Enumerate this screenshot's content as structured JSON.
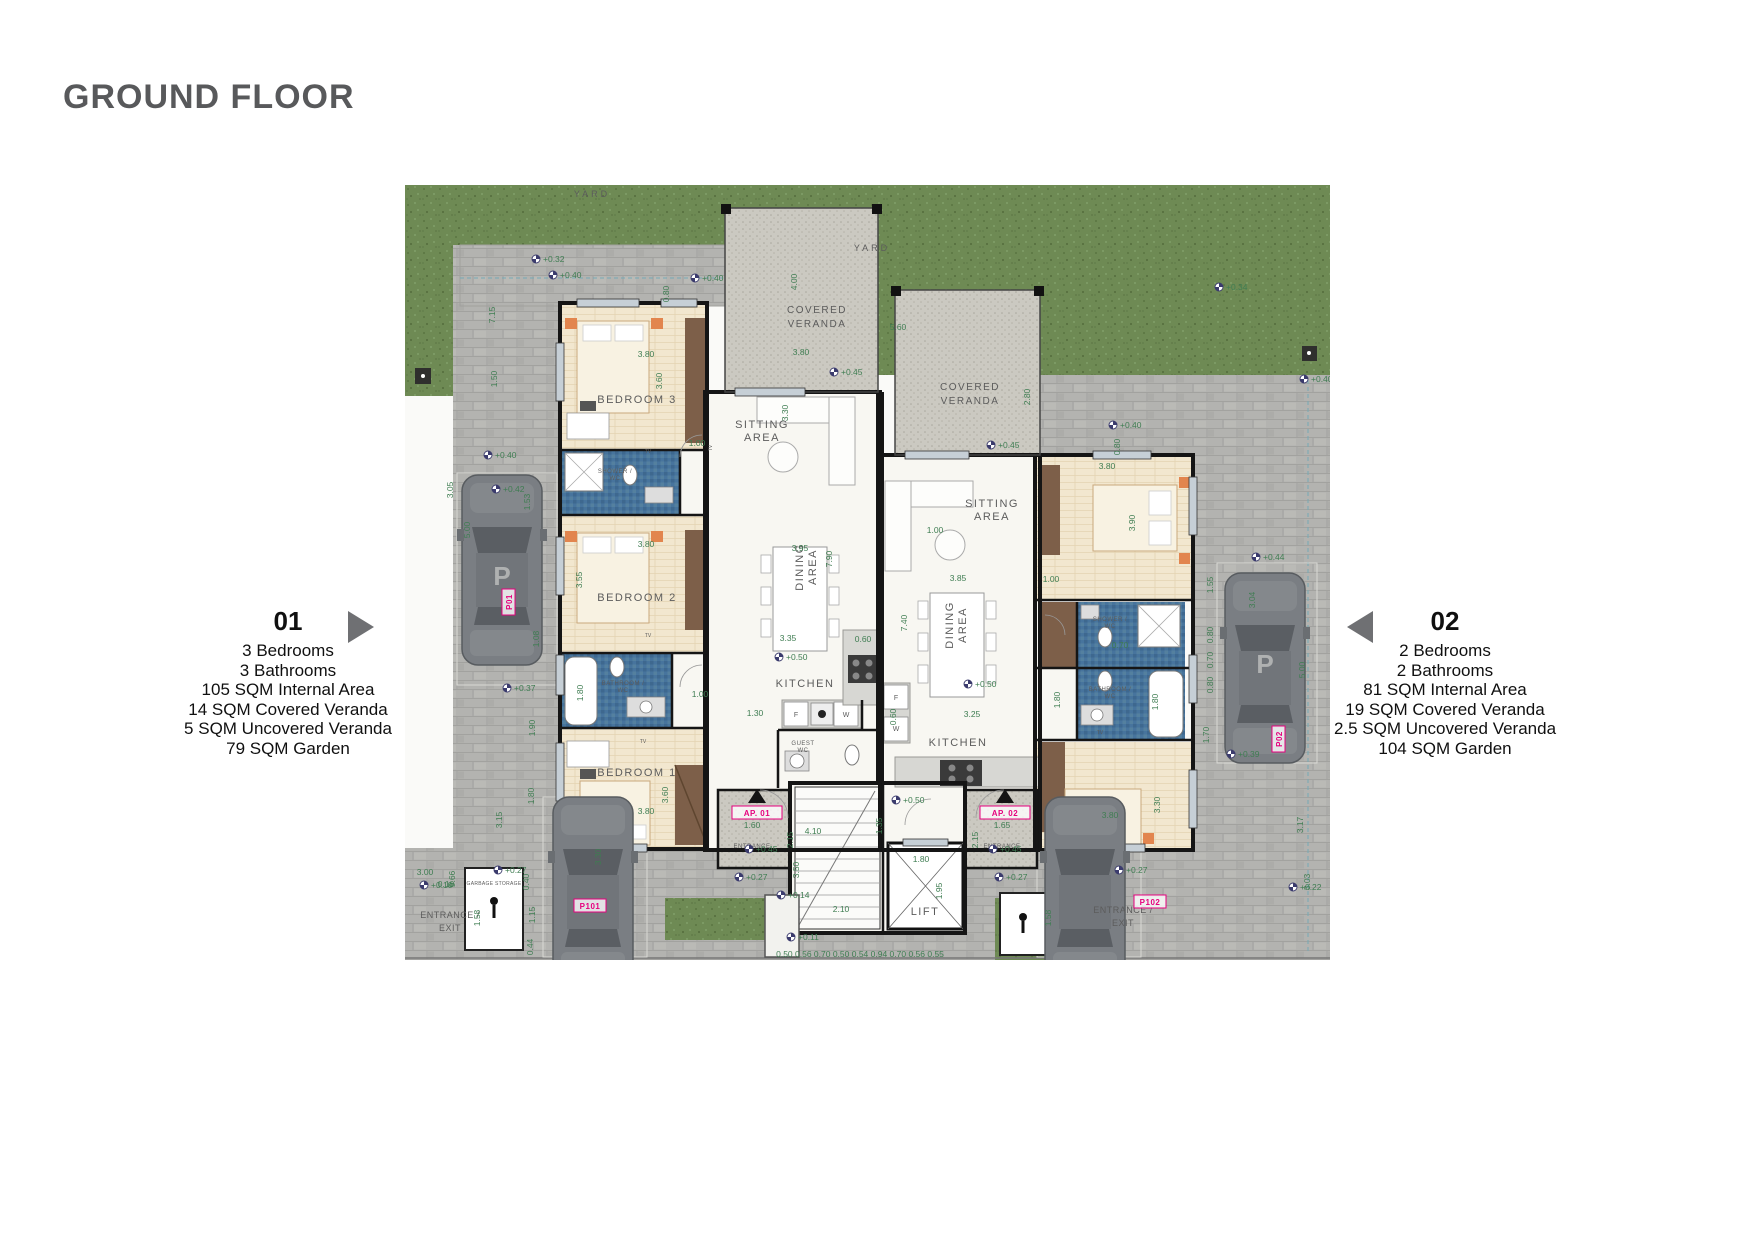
{
  "title": "GROUND FLOOR",
  "unit_left": {
    "number": "01",
    "details": [
      "3 Bedrooms",
      "3 Bathrooms",
      "105 SQM Internal Area",
      "14 SQM Covered Veranda",
      "5 SQM Uncovered Veranda",
      "79 SQM Garden"
    ]
  },
  "unit_right": {
    "number": "02",
    "details": [
      "2 Bedrooms",
      "2 Bathrooms",
      "81 SQM Internal Area",
      "19 SQM Covered Veranda",
      "2.5 SQM Uncovered Veranda",
      "104 SQM Garden"
    ]
  },
  "colors": {
    "dim_green": "#3F7D52",
    "magenta": "#E6007E",
    "marker_navy": "#3B3B6D",
    "title_gray": "#58595B"
  },
  "plan": {
    "room_labels": [
      {
        "lines": [
          "BEDROOM 3"
        ],
        "x": 232,
        "y": 218,
        "s": 11,
        "ls": 1.5
      },
      {
        "lines": [
          "BEDROOM 2"
        ],
        "x": 232,
        "y": 416,
        "s": 11,
        "ls": 1.5
      },
      {
        "lines": [
          "BEDROOM 1"
        ],
        "x": 232,
        "y": 591,
        "s": 11,
        "ls": 1.5
      },
      {
        "lines": [
          "SITTING",
          "AREA"
        ],
        "x": 357,
        "y": 243,
        "s": 11,
        "lh": 13,
        "ls": 1.5
      },
      {
        "lines": [
          "DINING",
          "AREA"
        ],
        "x": 398,
        "y": 382,
        "s": 11,
        "lh": 13,
        "ls": 1.5,
        "r": -90
      },
      {
        "lines": [
          "KITCHEN"
        ],
        "x": 400,
        "y": 502,
        "s": 11,
        "ls": 1.5
      },
      {
        "lines": [
          "GUEST",
          "WC"
        ],
        "x": 398,
        "y": 560,
        "s": 6,
        "lh": 7,
        "ls": 0.5
      },
      {
        "lines": [
          "COVERED",
          "VERANDA"
        ],
        "x": 412,
        "y": 128,
        "s": 10,
        "lh": 14,
        "ls": 1.5
      },
      {
        "lines": [
          "COVERED",
          "VERANDA"
        ],
        "x": 565,
        "y": 205,
        "s": 10,
        "lh": 14,
        "ls": 1.5
      },
      {
        "lines": [
          "SITTING",
          "AREA"
        ],
        "x": 587,
        "y": 322,
        "s": 11,
        "lh": 13,
        "ls": 1.5
      },
      {
        "lines": [
          "DINING",
          "AREA"
        ],
        "x": 548,
        "y": 440,
        "s": 11,
        "lh": 13,
        "ls": 1.5,
        "r": -90
      },
      {
        "lines": [
          "KITCHEN"
        ],
        "x": 553,
        "y": 561,
        "s": 11,
        "ls": 1.5
      },
      {
        "lines": [
          "SHOWER /",
          "WC"
        ],
        "x": 210,
        "y": 288,
        "s": 6,
        "lh": 7,
        "ls": 0.5
      },
      {
        "lines": [
          "BATHROOM /",
          "WC"
        ],
        "x": 218,
        "y": 500,
        "s": 6,
        "lh": 7,
        "ls": 0.5
      },
      {
        "lines": [
          "SHOWER /",
          "WC"
        ],
        "x": 705,
        "y": 436,
        "s": 6,
        "lh": 7,
        "ls": 0.5
      },
      {
        "lines": [
          "BATHROOM /",
          "WC"
        ],
        "x": 705,
        "y": 506,
        "s": 6,
        "lh": 7,
        "ls": 0.5
      },
      {
        "lines": [
          "LIFT"
        ],
        "x": 520,
        "y": 730,
        "s": 11,
        "ls": 1.5
      },
      {
        "lines": [
          "YARD"
        ],
        "x": 187,
        "y": 12,
        "s": 9,
        "ls": 3
      },
      {
        "lines": [
          "YARD"
        ],
        "x": 467,
        "y": 66,
        "s": 9,
        "ls": 3
      },
      {
        "lines": [
          "ENTRANCE"
        ],
        "x": 347,
        "y": 663,
        "s": 6,
        "ls": 0.5
      },
      {
        "lines": [
          "ENTRANCE"
        ],
        "x": 597,
        "y": 663,
        "s": 6,
        "ls": 0.5
      },
      {
        "lines": [
          "ENTRANCE /",
          "EXIT"
        ],
        "x": 45,
        "y": 733,
        "s": 9,
        "lh": 13,
        "ls": 0.5
      },
      {
        "lines": [
          "ENTRANCE /",
          "EXIT"
        ],
        "x": 718,
        "y": 728,
        "s": 9,
        "lh": 13,
        "ls": 0.5
      },
      {
        "lines": [
          "GARBAGE STORAGE"
        ],
        "x": 89,
        "y": 700,
        "s": 5,
        "ls": 0.3
      },
      {
        "lines": [
          "F"
        ],
        "x": 391,
        "y": 532,
        "s": 7,
        "ls": 0
      },
      {
        "lines": [
          "W"
        ],
        "x": 441,
        "y": 532,
        "s": 7,
        "ls": 0
      },
      {
        "lines": [
          "F"
        ],
        "x": 491,
        "y": 515,
        "s": 7,
        "ls": 0
      },
      {
        "lines": [
          "W"
        ],
        "x": 491,
        "y": 546,
        "s": 7,
        "ls": 0
      },
      {
        "lines": [
          "TV"
        ],
        "x": 243,
        "y": 268,
        "s": 5,
        "ls": 0
      },
      {
        "lines": [
          "TV"
        ],
        "x": 243,
        "y": 452,
        "s": 5,
        "ls": 0
      },
      {
        "lines": [
          "TV"
        ],
        "x": 238,
        "y": 558,
        "s": 5,
        "ls": 0
      },
      {
        "lines": [
          "TV"
        ],
        "x": 695,
        "y": 549,
        "s": 5,
        "ls": 0
      },
      {
        "lines": [
          "TV"
        ],
        "x": 307,
        "y": 263,
        "s": 5,
        "ls": 0,
        "r": -90
      }
    ],
    "tags": [
      {
        "t": "AP. 01",
        "x": 352,
        "y": 631,
        "w": 50
      },
      {
        "t": "AP. 02",
        "x": 600,
        "y": 631,
        "w": 50
      },
      {
        "t": "P101",
        "x": 185,
        "y": 724,
        "w": 32
      },
      {
        "t": "P102",
        "x": 745,
        "y": 720,
        "w": 32
      },
      {
        "t": "P01",
        "x": 107,
        "y": 417,
        "w": 26,
        "r": 1
      },
      {
        "t": "P02",
        "x": 877,
        "y": 554,
        "w": 26,
        "r": 1
      }
    ],
    "dims": [
      {
        "t": "3.80",
        "x": 241,
        "y": 172
      },
      {
        "t": "3.60",
        "x": 257,
        "y": 196,
        "r": 1
      },
      {
        "t": "3.80",
        "x": 396,
        "y": 170
      },
      {
        "t": "4.00",
        "x": 392,
        "y": 97,
        "r": 1
      },
      {
        "t": "0.80",
        "x": 264,
        "y": 109,
        "r": 1
      },
      {
        "t": "1.00",
        "x": 292,
        "y": 261
      },
      {
        "t": "3.80",
        "x": 241,
        "y": 362
      },
      {
        "t": "3.55",
        "x": 177,
        "y": 395,
        "r": 1
      },
      {
        "t": "1.80",
        "x": 178,
        "y": 508,
        "r": 1
      },
      {
        "t": "1.00",
        "x": 295,
        "y": 512
      },
      {
        "t": "3.80",
        "x": 241,
        "y": 629
      },
      {
        "t": "3.60",
        "x": 263,
        "y": 610,
        "r": 1
      },
      {
        "t": "3.95",
        "x": 395,
        "y": 366
      },
      {
        "t": "7.90",
        "x": 427,
        "y": 374,
        "r": 1
      },
      {
        "t": "3.35",
        "x": 383,
        "y": 456
      },
      {
        "t": "0.60",
        "x": 458,
        "y": 457
      },
      {
        "t": "1.30",
        "x": 350,
        "y": 531
      },
      {
        "t": "5.60",
        "x": 493,
        "y": 145
      },
      {
        "t": "3.30",
        "x": 383,
        "y": 228,
        "r": 1
      },
      {
        "t": "2.80",
        "x": 625,
        "y": 212,
        "r": 1
      },
      {
        "t": "3.85",
        "x": 553,
        "y": 396
      },
      {
        "t": "7.40",
        "x": 502,
        "y": 438,
        "r": 1
      },
      {
        "t": "3.25",
        "x": 567,
        "y": 532
      },
      {
        "t": "0.60",
        "x": 491,
        "y": 532,
        "r": 1
      },
      {
        "t": "1.00",
        "x": 646,
        "y": 397
      },
      {
        "t": "3.80",
        "x": 702,
        "y": 284
      },
      {
        "t": "3.90",
        "x": 730,
        "y": 338,
        "r": 1
      },
      {
        "t": "0.80",
        "x": 715,
        "y": 262,
        "r": 1
      },
      {
        "t": "0.70",
        "x": 715,
        "y": 463
      },
      {
        "t": "1.80",
        "x": 655,
        "y": 515,
        "r": 1
      },
      {
        "t": "1.80",
        "x": 753,
        "y": 517,
        "r": 1
      },
      {
        "t": "3.80",
        "x": 705,
        "y": 633
      },
      {
        "t": "3.30",
        "x": 755,
        "y": 620,
        "r": 1
      },
      {
        "t": "1.60",
        "x": 347,
        "y": 643
      },
      {
        "t": "1.65",
        "x": 597,
        "y": 643
      },
      {
        "t": "2.15",
        "x": 388,
        "y": 655,
        "r": 1
      },
      {
        "t": "2.15",
        "x": 573,
        "y": 655,
        "r": 1
      },
      {
        "t": "4.10",
        "x": 408,
        "y": 649
      },
      {
        "t": "1.35",
        "x": 477,
        "y": 641,
        "r": 1
      },
      {
        "t": "3.50",
        "x": 394,
        "y": 685,
        "r": 1
      },
      {
        "t": "2.10",
        "x": 436,
        "y": 727
      },
      {
        "t": "1.80",
        "x": 516,
        "y": 677
      },
      {
        "t": "1.95",
        "x": 537,
        "y": 706,
        "r": 1
      },
      {
        "t": "1.53",
        "x": 125,
        "y": 317,
        "r": 1
      },
      {
        "t": "1.08",
        "x": 134,
        "y": 454,
        "r": 1
      },
      {
        "t": "1.90",
        "x": 130,
        "y": 543,
        "r": 1
      },
      {
        "t": "1.80",
        "x": 129,
        "y": 611,
        "r": 1
      },
      {
        "t": "3.15",
        "x": 97,
        "y": 635,
        "r": 1
      },
      {
        "t": "5.00",
        "x": 65,
        "y": 345,
        "r": 1
      },
      {
        "t": "3.05",
        "x": 48,
        "y": 305,
        "r": 1
      },
      {
        "t": "7.15",
        "x": 90,
        "y": 130,
        "r": 1
      },
      {
        "t": "1.50",
        "x": 92,
        "y": 194,
        "r": 1
      },
      {
        "t": "9.66",
        "x": 50,
        "y": 694,
        "r": 1
      },
      {
        "t": "0.40",
        "x": 124,
        "y": 697,
        "r": 1
      },
      {
        "t": "1.15",
        "x": 130,
        "y": 730,
        "r": 1
      },
      {
        "t": "0.44",
        "x": 128,
        "y": 762,
        "r": 1
      },
      {
        "t": "3.00",
        "x": 20,
        "y": 690
      },
      {
        "t": "0.10",
        "x": 41,
        "y": 702
      },
      {
        "t": "3.30",
        "x": 196,
        "y": 672,
        "r": 1
      },
      {
        "t": "0.50 0.56 0.70 0.50 0.54 0.94 0.70 0.56 0.55",
        "x": 455,
        "y": 772
      },
      {
        "t": "1.58",
        "x": 75,
        "y": 733,
        "r": 1
      },
      {
        "t": "1.58",
        "x": 646,
        "y": 733,
        "r": 1
      },
      {
        "t": "3.03",
        "x": 905,
        "y": 697,
        "r": 1
      },
      {
        "t": "3.17",
        "x": 898,
        "y": 640,
        "r": 1
      },
      {
        "t": "1.55",
        "x": 808,
        "y": 400,
        "r": 1
      },
      {
        "t": "0.80",
        "x": 808,
        "y": 450,
        "r": 1
      },
      {
        "t": "0.70",
        "x": 808,
        "y": 475,
        "r": 1
      },
      {
        "t": "0.80",
        "x": 808,
        "y": 500,
        "r": 1
      },
      {
        "t": "1.70",
        "x": 804,
        "y": 550,
        "r": 1
      },
      {
        "t": "3.04",
        "x": 850,
        "y": 415,
        "r": 1
      },
      {
        "t": "5.00",
        "x": 900,
        "y": 485,
        "r": 1
      },
      {
        "t": "1.00",
        "x": 530,
        "y": 348
      }
    ],
    "levels": [
      {
        "t": "+0.32",
        "x": 140,
        "y": 77
      },
      {
        "t": "+0.40",
        "x": 157,
        "y": 93
      },
      {
        "t": "+0.40",
        "x": 299,
        "y": 96
      },
      {
        "t": "+0.45",
        "x": 438,
        "y": 190
      },
      {
        "t": "+0.45",
        "x": 595,
        "y": 263
      },
      {
        "t": "+0.40",
        "x": 717,
        "y": 243
      },
      {
        "t": "+0.34",
        "x": 823,
        "y": 105
      },
      {
        "t": "+0.40",
        "x": 908,
        "y": 197
      },
      {
        "t": "+0.44",
        "x": 860,
        "y": 375
      },
      {
        "t": "+0.40",
        "x": 92,
        "y": 273
      },
      {
        "t": "+0.42",
        "x": 100,
        "y": 307
      },
      {
        "t": "+0.37",
        "x": 111,
        "y": 506
      },
      {
        "t": "+0.27",
        "x": 102,
        "y": 688
      },
      {
        "t": "+0.50",
        "x": 383,
        "y": 475
      },
      {
        "t": "+0.45",
        "x": 353,
        "y": 667
      },
      {
        "t": "+0.27",
        "x": 343,
        "y": 695
      },
      {
        "t": "+0.50",
        "x": 500,
        "y": 618
      },
      {
        "t": "+0.50",
        "x": 572,
        "y": 502
      },
      {
        "t": "+0.45",
        "x": 597,
        "y": 667
      },
      {
        "t": "+0.27",
        "x": 603,
        "y": 695
      },
      {
        "t": "+0.27",
        "x": 723,
        "y": 688
      },
      {
        "t": "+0.39",
        "x": 835,
        "y": 572
      },
      {
        "t": "+0.22",
        "x": 897,
        "y": 705
      },
      {
        "t": "+0.14",
        "x": 385,
        "y": 713
      },
      {
        "t": "+0.11",
        "x": 395,
        "y": 755
      },
      {
        "t": "+0.10",
        "x": 28,
        "y": 703
      }
    ]
  }
}
